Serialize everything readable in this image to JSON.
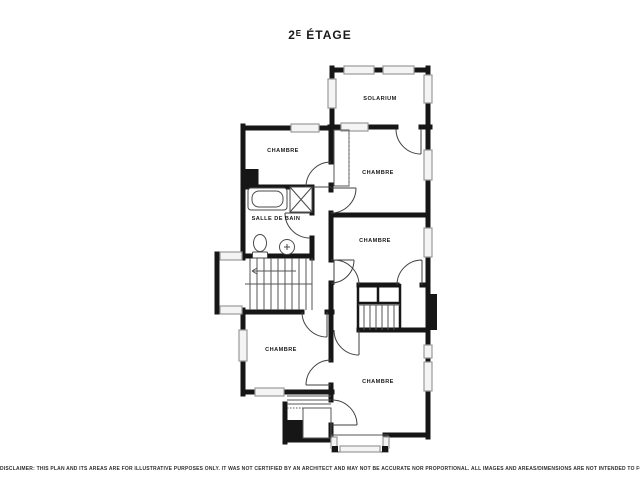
{
  "page": {
    "title": "2ᴱ ÉTAGE",
    "disclaimer": "DISCLAIMER: THIS PLAN AND ITS AREAS ARE FOR ILLUSTRATIVE PURPOSES ONLY. IT WAS NOT CERTIFIED BY AN ARCHITECT AND MAY NOT BE ACCURATE NOR PROPORTIONAL. ALL IMAGES AND AREAS/DIMENSIONS ARE NOT INTENDED TO FORM ANY CONTRACT OR WARRANTY."
  },
  "floor_plan": {
    "rooms": [
      {
        "id": "solarium",
        "label": "SOLARIUM"
      },
      {
        "id": "chambre-top-left",
        "label": "CHAMBRE"
      },
      {
        "id": "chambre-mid-right",
        "label": "CHAMBRE"
      },
      {
        "id": "salle-de-bain",
        "label": "SALLE DE BAIN"
      },
      {
        "id": "chambre-right",
        "label": "CHAMBRE"
      },
      {
        "id": "chambre-bottom-left",
        "label": "CHAMBRE"
      },
      {
        "id": "chambre-bottom-right",
        "label": "CHAMBRE"
      }
    ],
    "features": [
      "main staircase",
      "secondary staircase",
      "bathtub",
      "shower",
      "toilet",
      "sink",
      "closets",
      "bay window",
      "balcony railing"
    ],
    "colors": {
      "wall": "#161616",
      "window_stroke": "#9a9a9a",
      "window_fill": "#f4f4f4",
      "fixture_stroke": "#4a4a4a",
      "text": "#1b1b1b",
      "background": "#ffffff"
    }
  }
}
